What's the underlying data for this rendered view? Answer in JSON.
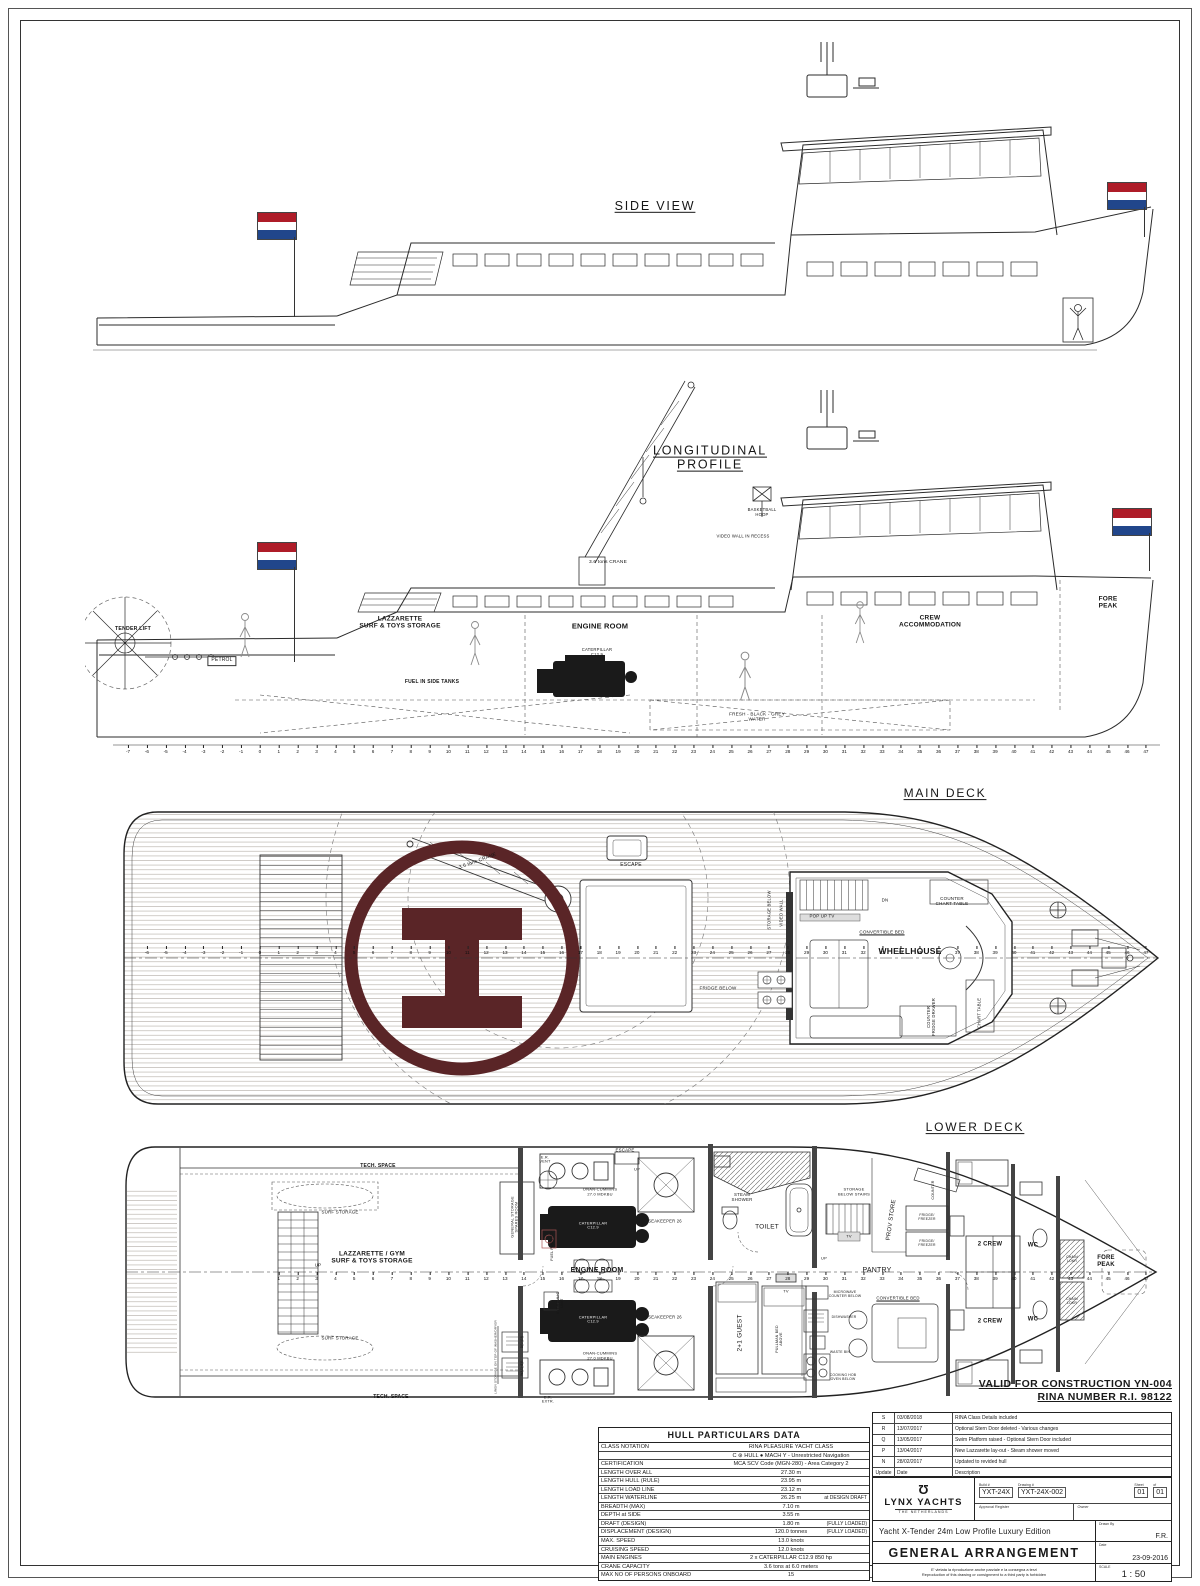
{
  "page": {
    "valid_line1": "VALID FOR CONSTRUCTION YN-004",
    "valid_line2": "RINA NUMBER R.I. 98122"
  },
  "flags": {
    "country": "netherlands",
    "stripes": [
      "#AE1C28",
      "#FFFFFF",
      "#21468B"
    ]
  },
  "helipad": {
    "symbol": "H",
    "color": "#5a2527"
  },
  "frame_rulers": {
    "longitudinal": {
      "start": -7,
      "end": 47
    },
    "main_deck": {
      "start": -6,
      "end": 47
    },
    "lower_deck": {
      "start": 1,
      "end": 47
    }
  },
  "views": {
    "side": {
      "labels": [
        {
          "t": "SIDE VIEW",
          "x": 570,
          "y": 176,
          "fs": 12.5,
          "cls": "vtitle"
        }
      ]
    },
    "longitudinal": {
      "labels": [
        {
          "t": "LONGITUDINAL\nPROFILE",
          "x": 625,
          "y": 93,
          "fs": 12.5,
          "cls": "vtitle"
        },
        {
          "t": "BASKETBALL\nHOOP",
          "x": 677,
          "y": 148,
          "fs": 4.2
        },
        {
          "t": "VIDEO WALL IN RECESS",
          "x": 658,
          "y": 172,
          "fs": 4.2
        },
        {
          "t": "3.6 tons CRANE",
          "x": 523,
          "y": 198,
          "fs": 4.8
        },
        {
          "t": "TENDER LIFT",
          "x": 48,
          "y": 265,
          "fs": 5.2,
          "b": 1
        },
        {
          "t": "PETROL",
          "x": 137,
          "y": 296,
          "fs": 5,
          "cls": "box"
        },
        {
          "t": "LAZZARETTE\nSURF & TOYS STORAGE",
          "x": 315,
          "y": 258,
          "fs": 6.5,
          "b": 1
        },
        {
          "t": "ENGINE ROOM",
          "x": 515,
          "y": 262,
          "fs": 7.5,
          "b": 1
        },
        {
          "t": "CATERPILLAR\nC12.9",
          "x": 512,
          "y": 288,
          "fs": 4.2
        },
        {
          "t": "FUEL IN SIDE TANKS",
          "x": 347,
          "y": 318,
          "fs": 5,
          "b": 1
        },
        {
          "t": "FRESH - BLACK - GREY\nWATER",
          "x": 672,
          "y": 352,
          "fs": 4.6
        },
        {
          "t": "CREW\nACCOMMODATION",
          "x": 845,
          "y": 257,
          "fs": 6.5,
          "b": 1
        },
        {
          "t": "FORE\nPEAK",
          "x": 1023,
          "y": 238,
          "fs": 6.5,
          "b": 1
        }
      ]
    },
    "main_deck": {
      "labels": [
        {
          "t": "MAIN DECK",
          "x": 835,
          "y": 14,
          "fs": 12,
          "cls": "vtitle"
        },
        {
          "t": "ESCAPE",
          "x": 521,
          "y": 86,
          "fs": 5
        },
        {
          "t": "3.6 tons CRANE",
          "x": 368,
          "y": 82,
          "fs": 5,
          "r": -20
        },
        {
          "t": "STORAGE BELOW",
          "x": 660,
          "y": 130,
          "fs": 4.2,
          "r": -90
        },
        {
          "t": "VIDEO WALL",
          "x": 672,
          "y": 133,
          "fs": 4.2,
          "r": -90
        },
        {
          "t": "POP UP TV",
          "x": 712,
          "y": 136,
          "fs": 4.4
        },
        {
          "t": "DN",
          "x": 775,
          "y": 120,
          "fs": 4.4
        },
        {
          "t": "COUNTER\nCHART TABLE",
          "x": 842,
          "y": 121,
          "fs": 4.5
        },
        {
          "t": "CONVERTIBLE BED",
          "x": 772,
          "y": 152,
          "fs": 4.5,
          "cls": "ul"
        },
        {
          "t": "WHEELHOUSE",
          "x": 800,
          "y": 172,
          "fs": 8.5,
          "b": 1
        },
        {
          "t": "FRIDGE BELOW",
          "x": 608,
          "y": 208,
          "fs": 4.5
        },
        {
          "t": "COUNTER\nFRIDGE DRAWER",
          "x": 822,
          "y": 237,
          "fs": 4.2,
          "r": -90
        },
        {
          "t": "CHART TABLE",
          "x": 870,
          "y": 233,
          "fs": 4.2,
          "r": -90
        }
      ]
    },
    "lower_deck": {
      "labels": [
        {
          "t": "LOWER DECK",
          "x": 865,
          "y": 8,
          "fs": 12,
          "cls": "vtitle"
        },
        {
          "t": "TECH. SPACE",
          "x": 268,
          "y": 47,
          "fs": 5,
          "b": 1
        },
        {
          "t": "E.R.\nVENT",
          "x": 435,
          "y": 40,
          "fs": 3.8
        },
        {
          "t": "ESCAPE",
          "x": 515,
          "y": 30,
          "fs": 4.4
        },
        {
          "t": "UP",
          "x": 527,
          "y": 50,
          "fs": 4
        },
        {
          "t": "SURF STORAGE",
          "x": 230,
          "y": 92,
          "fs": 4.4
        },
        {
          "t": "ONAN-CUMMINS\n27.0 MDKBU",
          "x": 490,
          "y": 72,
          "fs": 4
        },
        {
          "t": "SEAKEEPER 26",
          "x": 555,
          "y": 102,
          "fs": 4.2
        },
        {
          "t": "CATERPILLAR\nC12.9",
          "x": 483,
          "y": 106,
          "fs": 3.9,
          "cls": "wh"
        },
        {
          "t": "GENERAL STORAGE\nSPARES ROOM",
          "x": 405,
          "y": 97,
          "fs": 3.9,
          "r": -90
        },
        {
          "t": "UP",
          "x": 208,
          "y": 145,
          "fs": 4.4
        },
        {
          "t": "LAZZARETTE / GYM\nSURF & TOYS STORAGE",
          "x": 262,
          "y": 138,
          "fs": 6.5,
          "b": 1
        },
        {
          "t": "FUEL PURIFIER",
          "x": 442,
          "y": 126,
          "fs": 3.6,
          "r": -90
        },
        {
          "t": "ENGINE ROOM",
          "x": 487,
          "y": 151,
          "fs": 7,
          "b": 1
        },
        {
          "t": "HYDRAULIC\nUNIT",
          "x": 450,
          "y": 183,
          "fs": 3.6,
          "r": -90
        },
        {
          "t": "CATERPILLAR\nC12.9",
          "x": 483,
          "y": 200,
          "fs": 3.9,
          "cls": "wh"
        },
        {
          "t": "ONAN-CUMMINS\n27.0 MDKBU",
          "x": 490,
          "y": 236,
          "fs": 4
        },
        {
          "t": "SEAKEEPER 26",
          "x": 555,
          "y": 198,
          "fs": 4.2
        },
        {
          "t": "SURF STORAGE",
          "x": 230,
          "y": 218,
          "fs": 4.4
        },
        {
          "t": "TECH. SPACE",
          "x": 281,
          "y": 278,
          "fs": 5,
          "b": 1
        },
        {
          "t": "E.R.\nEXTR.",
          "x": 438,
          "y": 280,
          "fs": 3.8
        },
        {
          "t": "LINEN STORAGE ON TOP OF WASHER/DRYER",
          "x": 386,
          "y": 237,
          "fs": 3,
          "r": -90
        },
        {
          "t": "DRYER",
          "x": 413,
          "y": 222,
          "fs": 3.3,
          "r": -90
        },
        {
          "t": "WASHER",
          "x": 413,
          "y": 248,
          "fs": 3.3,
          "r": -90
        },
        {
          "t": "STEAM\nSHOWER",
          "x": 632,
          "y": 77,
          "fs": 4.4
        },
        {
          "t": "TOILET",
          "x": 657,
          "y": 107,
          "fs": 6.5
        },
        {
          "t": "STORAGE\nBELOW STAIRS",
          "x": 744,
          "y": 72,
          "fs": 4
        },
        {
          "t": "COUNTER",
          "x": 823,
          "y": 70,
          "fs": 3.6,
          "r": -90
        },
        {
          "t": "TV",
          "x": 739,
          "y": 117,
          "fs": 4
        },
        {
          "t": "UP",
          "x": 714,
          "y": 139,
          "fs": 4
        },
        {
          "t": "PROV STORE",
          "x": 782,
          "y": 100,
          "fs": 6,
          "r": -82
        },
        {
          "t": "FRIDGE/\nFREEZER",
          "x": 817,
          "y": 98,
          "fs": 3.4
        },
        {
          "t": "FRIDGE/\nFREEZER",
          "x": 817,
          "y": 124,
          "fs": 3.4
        },
        {
          "t": "PANTRY",
          "x": 767,
          "y": 151,
          "fs": 7
        },
        {
          "t": "MICROWAVE\nCOUNTER BELOW",
          "x": 735,
          "y": 175,
          "fs": 3.4
        },
        {
          "t": "CONVERTIBLE BED",
          "x": 788,
          "y": 179,
          "fs": 4.3,
          "cls": "ul"
        },
        {
          "t": "DISHWASHER",
          "x": 734,
          "y": 198,
          "fs": 3.4
        },
        {
          "t": "WASTE BIN",
          "x": 730,
          "y": 233,
          "fs": 3.4
        },
        {
          "t": "COOKING HOB\nOVEN BELOW",
          "x": 733,
          "y": 258,
          "fs": 3.4
        },
        {
          "t": "2+1 GUEST",
          "x": 630,
          "y": 213,
          "fs": 6.5,
          "r": -90
        },
        {
          "t": "PULLMAN BED\nABOVE",
          "x": 669,
          "y": 219,
          "fs": 3.6,
          "r": -90
        },
        {
          "t": "TV",
          "x": 676,
          "y": 172,
          "fs": 4
        },
        {
          "t": "2 CREW",
          "x": 880,
          "y": 125,
          "fs": 6,
          "b": 1
        },
        {
          "t": "2 CREW",
          "x": 880,
          "y": 202,
          "fs": 6,
          "b": 1
        },
        {
          "t": "WC",
          "x": 923,
          "y": 126,
          "fs": 6,
          "b": 1
        },
        {
          "t": "WC",
          "x": 923,
          "y": 200,
          "fs": 6,
          "b": 1
        },
        {
          "t": "CHAIN\nLOKR",
          "x": 962,
          "y": 140,
          "fs": 3.4
        },
        {
          "t": "CHAIN\nLOKR",
          "x": 962,
          "y": 182,
          "fs": 3.4
        },
        {
          "t": "FORE\nPEAK",
          "x": 996,
          "y": 142,
          "fs": 6,
          "b": 1
        }
      ]
    }
  },
  "hull_particulars": {
    "title": "HULL PARTICULARS DATA",
    "rows": [
      {
        "label": "CLASS NOTATION",
        "value": "RINA PLEASURE YACHT CLASS",
        "note": ""
      },
      {
        "label": "",
        "value": "C ⊛ HULL ● MACH Y - Unrestricted Navigation",
        "note": ""
      },
      {
        "label": "CERTIFICATION",
        "value": "MCA SCV Code (MGN-280) - Area Category 2",
        "note": ""
      },
      {
        "label": "LENGTH OVER ALL",
        "value": "27.30  m",
        "note": ""
      },
      {
        "label": "LENGTH HULL (RULE)",
        "value": "23.95  m",
        "note": ""
      },
      {
        "label": "LENGTH LOAD LINE",
        "value": "23.12  m",
        "note": ""
      },
      {
        "label": "LENGTH WATERLINE",
        "value": "26.25  m",
        "note": "at DESIGN DRAFT"
      },
      {
        "label": "BREADTH (MAX)",
        "value": "7.10  m",
        "note": ""
      },
      {
        "label": "DEPTH at SIDE",
        "value": "3.55  m",
        "note": ""
      },
      {
        "label": "DRAFT (DESIGN)",
        "value": "1.80  m",
        "note": "(FULLY LOADED)"
      },
      {
        "label": "DISPLACEMENT (DESIGN)",
        "value": "120.0  tonnes",
        "note": "(FULLY LOADED)"
      },
      {
        "label": "MAX. SPEED",
        "value": "13.0  knots",
        "note": ""
      },
      {
        "label": "CRUISING SPEED",
        "value": "12.0  knots",
        "note": ""
      },
      {
        "label": "MAIN ENGINES",
        "value": "2 x CATERPILLAR C12.9 850 hp",
        "note": ""
      },
      {
        "label": "CRANE CAPACITY",
        "value": "3.6 tons at 6.0 meters",
        "note": ""
      },
      {
        "label": "MAX NO OF PERSONS ONBOARD",
        "value": "15",
        "note": ""
      }
    ]
  },
  "revisions": {
    "rows": [
      {
        "rev": "S",
        "date": "03/08/2018",
        "desc": "RINA Class Details included"
      },
      {
        "rev": "R",
        "date": "13/07/2017",
        "desc": "Optional Stern Door deleted - Various changes"
      },
      {
        "rev": "Q",
        "date": "13/05/2017",
        "desc": "Swim Platform raised - Optional Stern Door included"
      },
      {
        "rev": "P",
        "date": "13/04/2017",
        "desc": "New Lazzarette lay-out - Steam shower moved"
      },
      {
        "rev": "N",
        "date": "28/02/2017",
        "desc": "Updated to revided hull"
      },
      {
        "rev": "Update",
        "date": "Date",
        "desc": "Description"
      }
    ]
  },
  "title_block": {
    "logo_glyph": "Ʊ",
    "brand": "LYNX YACHTS",
    "brand_sub": "THE NETHERLANDS",
    "build_label": "Build #",
    "build_no": "YXT-24X",
    "drawing_label": "Drawing #",
    "drawing_no": "YXT-24X-002",
    "sheet_label": "Sheet",
    "sheet": "01",
    "of_label": "of",
    "of": "01",
    "approval_label": "Approval Register",
    "owner_label": "Owner",
    "subtitle": "Yacht X-Tender   24m Low Profile Luxury Edition",
    "drawn_by_label": "Drawn By",
    "drawn_by": "F.R.",
    "main_title": "GENERAL ARRANGEMENT",
    "date_label": "Date",
    "date": "23-09-2016",
    "disclaimer_it": "E' vietata la riproduzione anche parziale e la consegna a terzi",
    "disclaimer_en": "Reproduction of this drawing or consignment to a third party is forbidden",
    "scale_label": "SCALE",
    "scale": "1 : 50"
  }
}
